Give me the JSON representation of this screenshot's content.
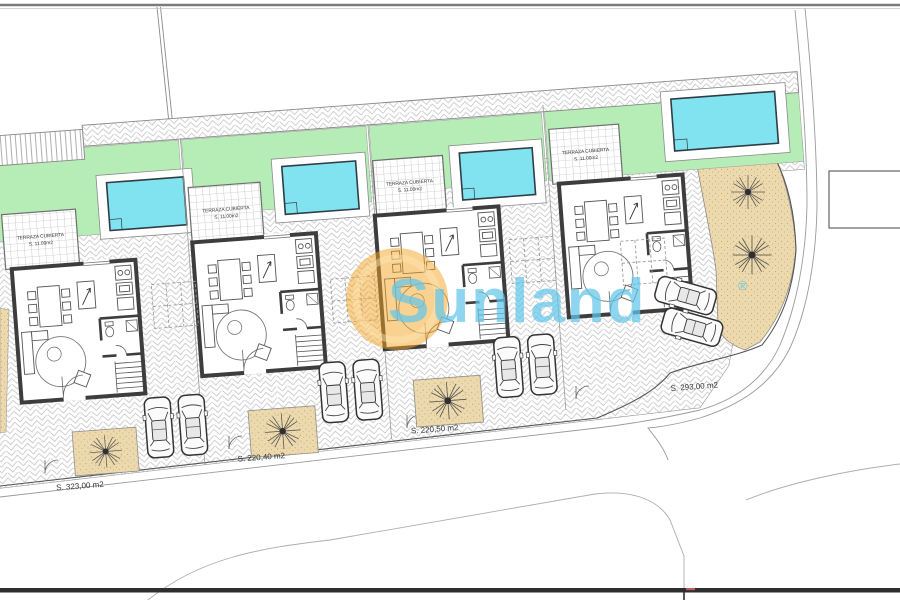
{
  "watermark": {
    "brand": "Sunland",
    "registered": "®"
  },
  "plots": [
    {
      "name": "plot-1",
      "area_label": "S. 323,00 m2",
      "terrace_label": [
        "TERRAZA CUBIERTA",
        "S. 11.00m2"
      ]
    },
    {
      "name": "plot-2",
      "area_label": "S. 220,40 m2",
      "terrace_label": [
        "TERRAZA CUBIERTA",
        "S. 11.00m2"
      ]
    },
    {
      "name": "plot-3",
      "area_label": "S. 220,50 m2",
      "terrace_label": [
        "TERRAZA CUBIERTA",
        "S. 11.00m2"
      ]
    },
    {
      "name": "plot-4",
      "area_label": "S. 293,00 m2",
      "terrace_label": [
        "TERRAZA CUBIERTA",
        "S. 11.00m2"
      ]
    }
  ],
  "colors": {
    "garden_green": "#b6edb6",
    "pool_water": "#82e3f0",
    "sand": "#ecd9ad",
    "wall_dark": "#3d3d3d",
    "watermark_orange": "#f3a424",
    "watermark_blue": "#63c6e9"
  }
}
